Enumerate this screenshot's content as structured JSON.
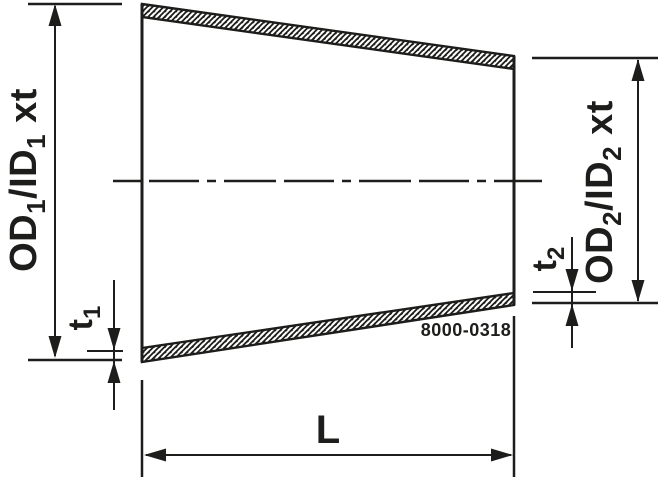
{
  "drawing": {
    "description": "concentric-reducer-dimension-drawing",
    "part_number": "8000-0318",
    "colors": {
      "line": "#1d1d1b",
      "background": "#ffffff"
    },
    "labels": {
      "length": "L",
      "left_diameter": {
        "p1": "OD",
        "s1": "1",
        "p2": "/ID",
        "s2": "1",
        "p3": " xt"
      },
      "right_diameter": {
        "p1": "OD",
        "s1": "2",
        "p2": "/ID",
        "s2": "2",
        "p3": " xt"
      },
      "left_thickness": {
        "base": "t",
        "sub": "1"
      },
      "right_thickness": {
        "base": "t",
        "sub": "2"
      }
    }
  }
}
